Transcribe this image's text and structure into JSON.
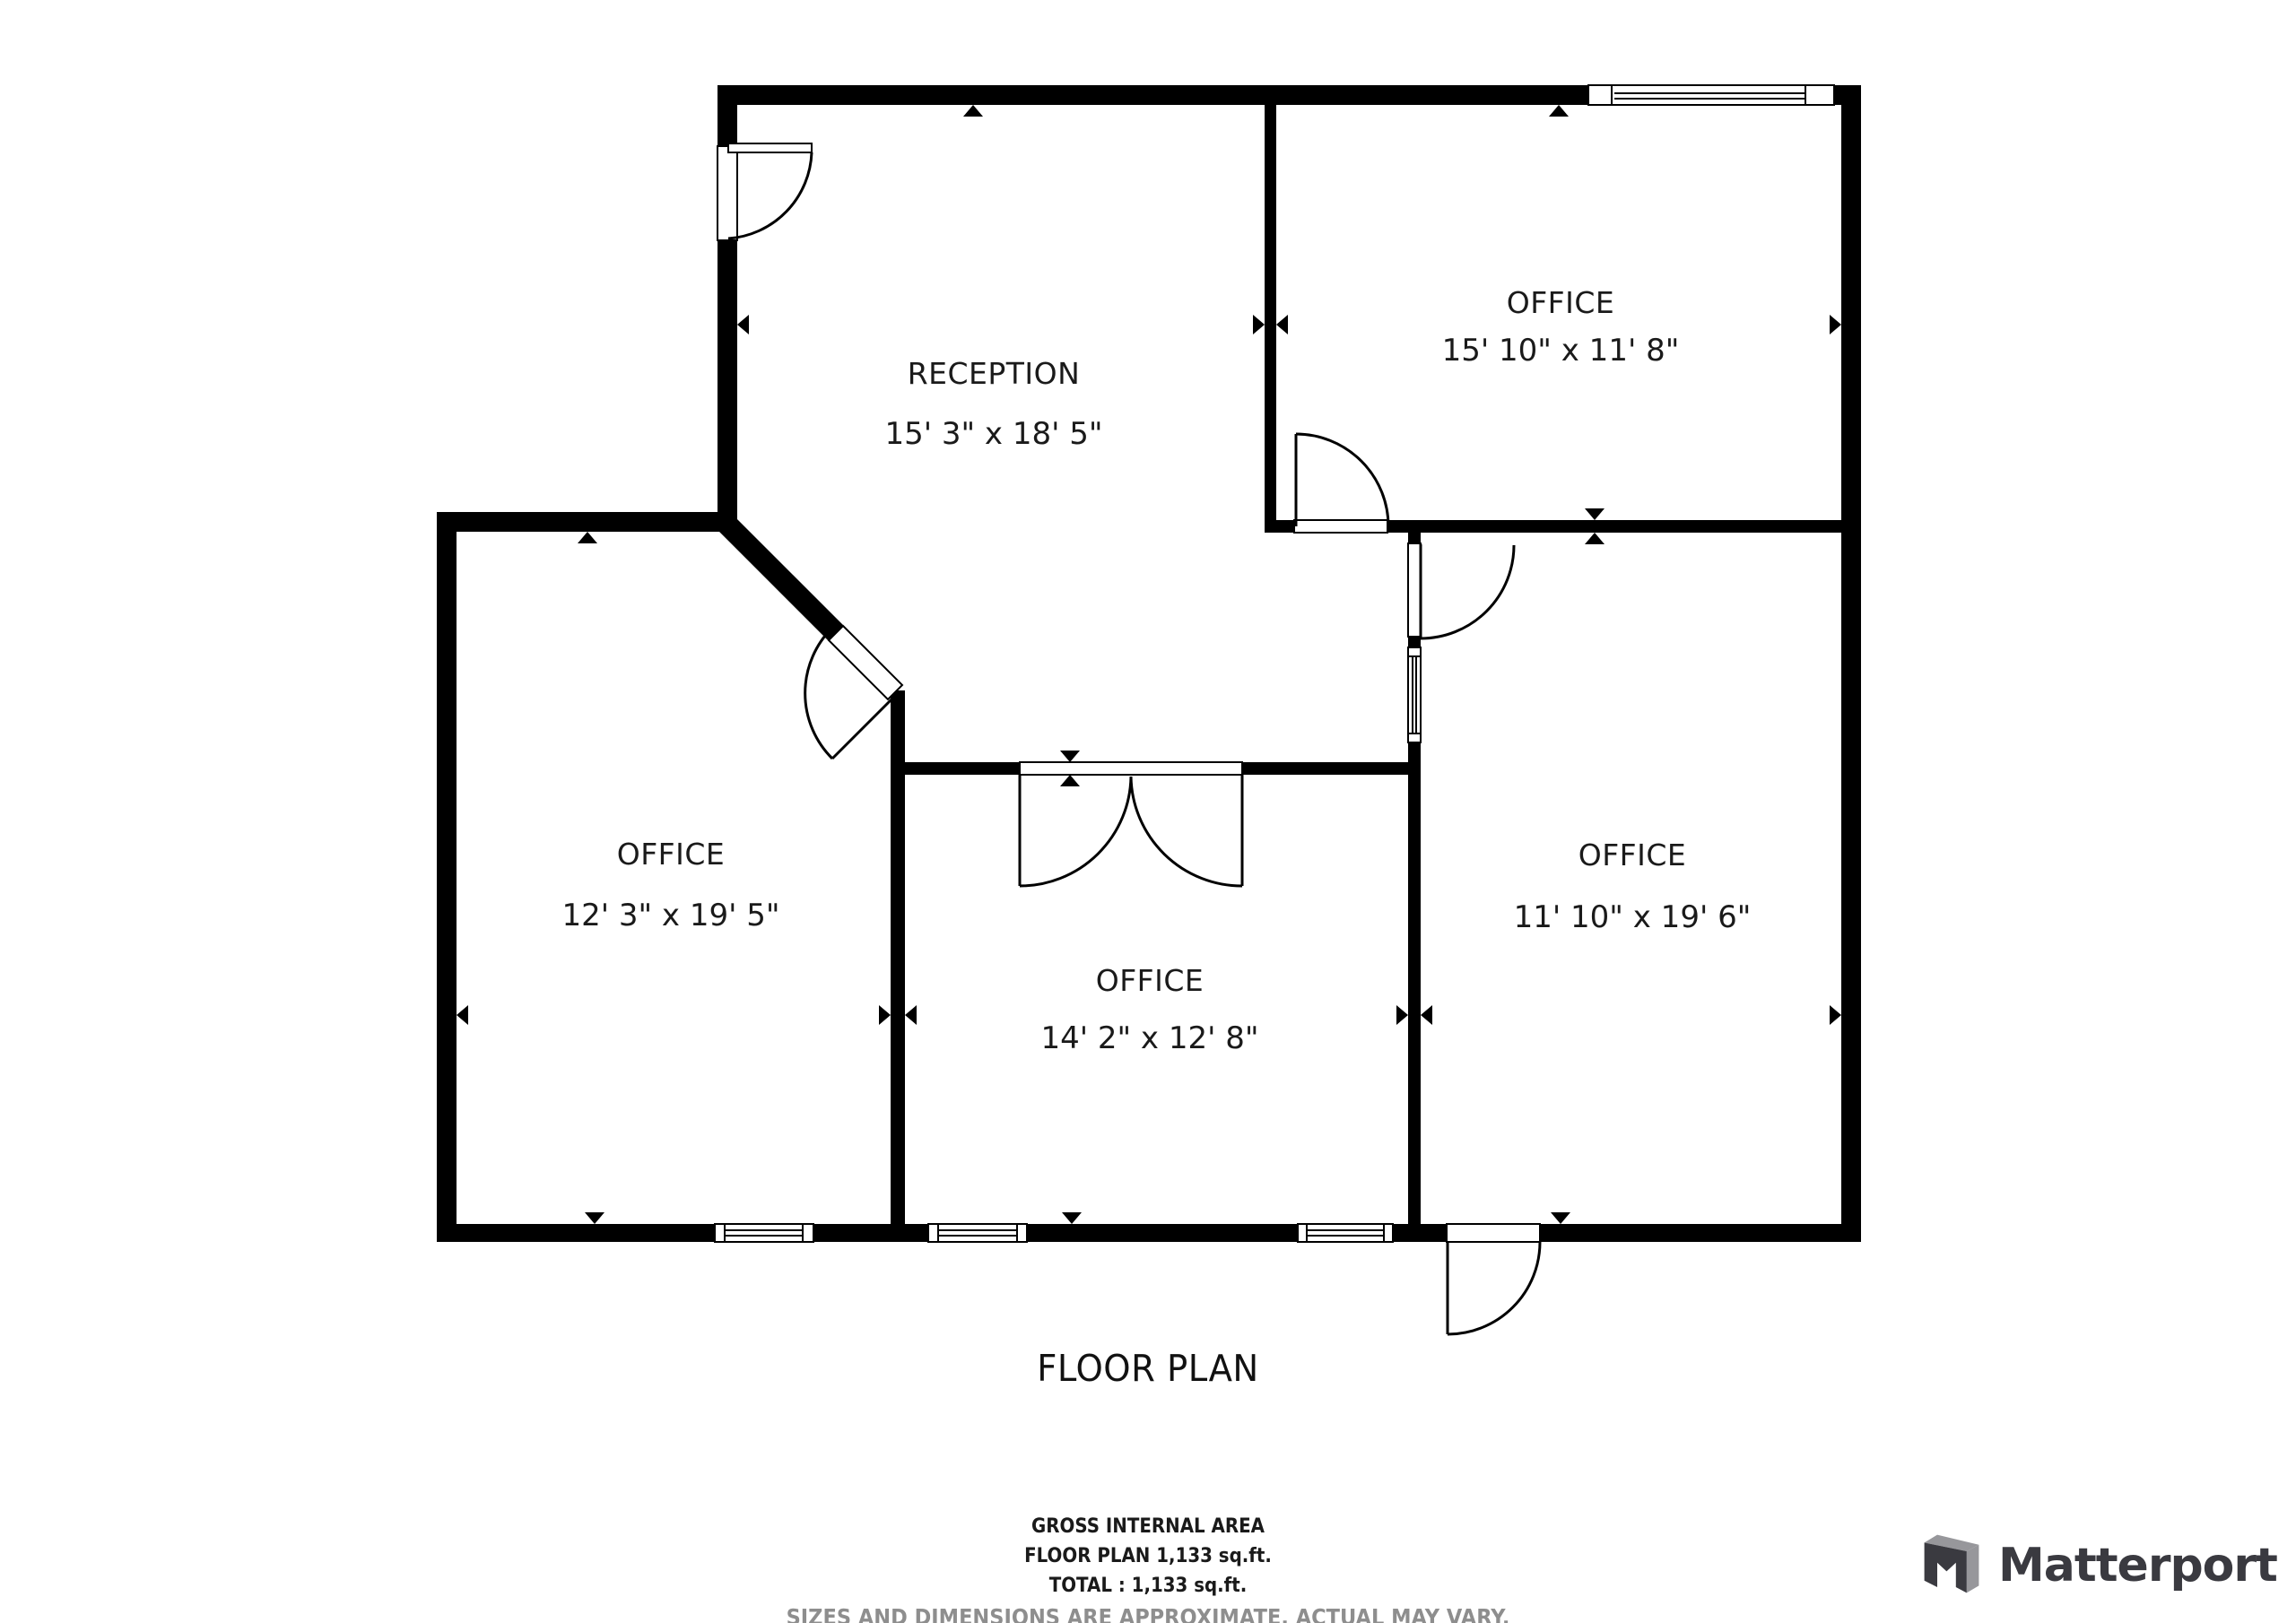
{
  "plan": {
    "title": "FLOOR PLAN",
    "rooms": [
      {
        "name": "RECEPTION",
        "dims": "15' 3\" x 18' 5\""
      },
      {
        "name": "OFFICE",
        "dims": "15' 10\" x 11' 8\""
      },
      {
        "name": "OFFICE",
        "dims": "12' 3\" x 19' 5\""
      },
      {
        "name": "OFFICE",
        "dims": "14' 2\" x 12' 8\""
      },
      {
        "name": "OFFICE",
        "dims": "11' 10\" x 19' 6\""
      }
    ]
  },
  "footer": {
    "line1": "GROSS INTERNAL AREA",
    "line2": "FLOOR PLAN 1,133 sq.ft.",
    "line3": "TOTAL :  1,133 sq.ft.",
    "disclaimer": "SIZES AND DIMENSIONS ARE APPROXIMATE, ACTUAL MAY VARY."
  },
  "branding": {
    "wordmark": "Matterport"
  },
  "colors": {
    "wall": "#000000",
    "text": "#1a1a1a",
    "disclaimer": "#8e8e8e",
    "logo_dark": "#3a3a40",
    "logo_gray": "#97979b"
  }
}
